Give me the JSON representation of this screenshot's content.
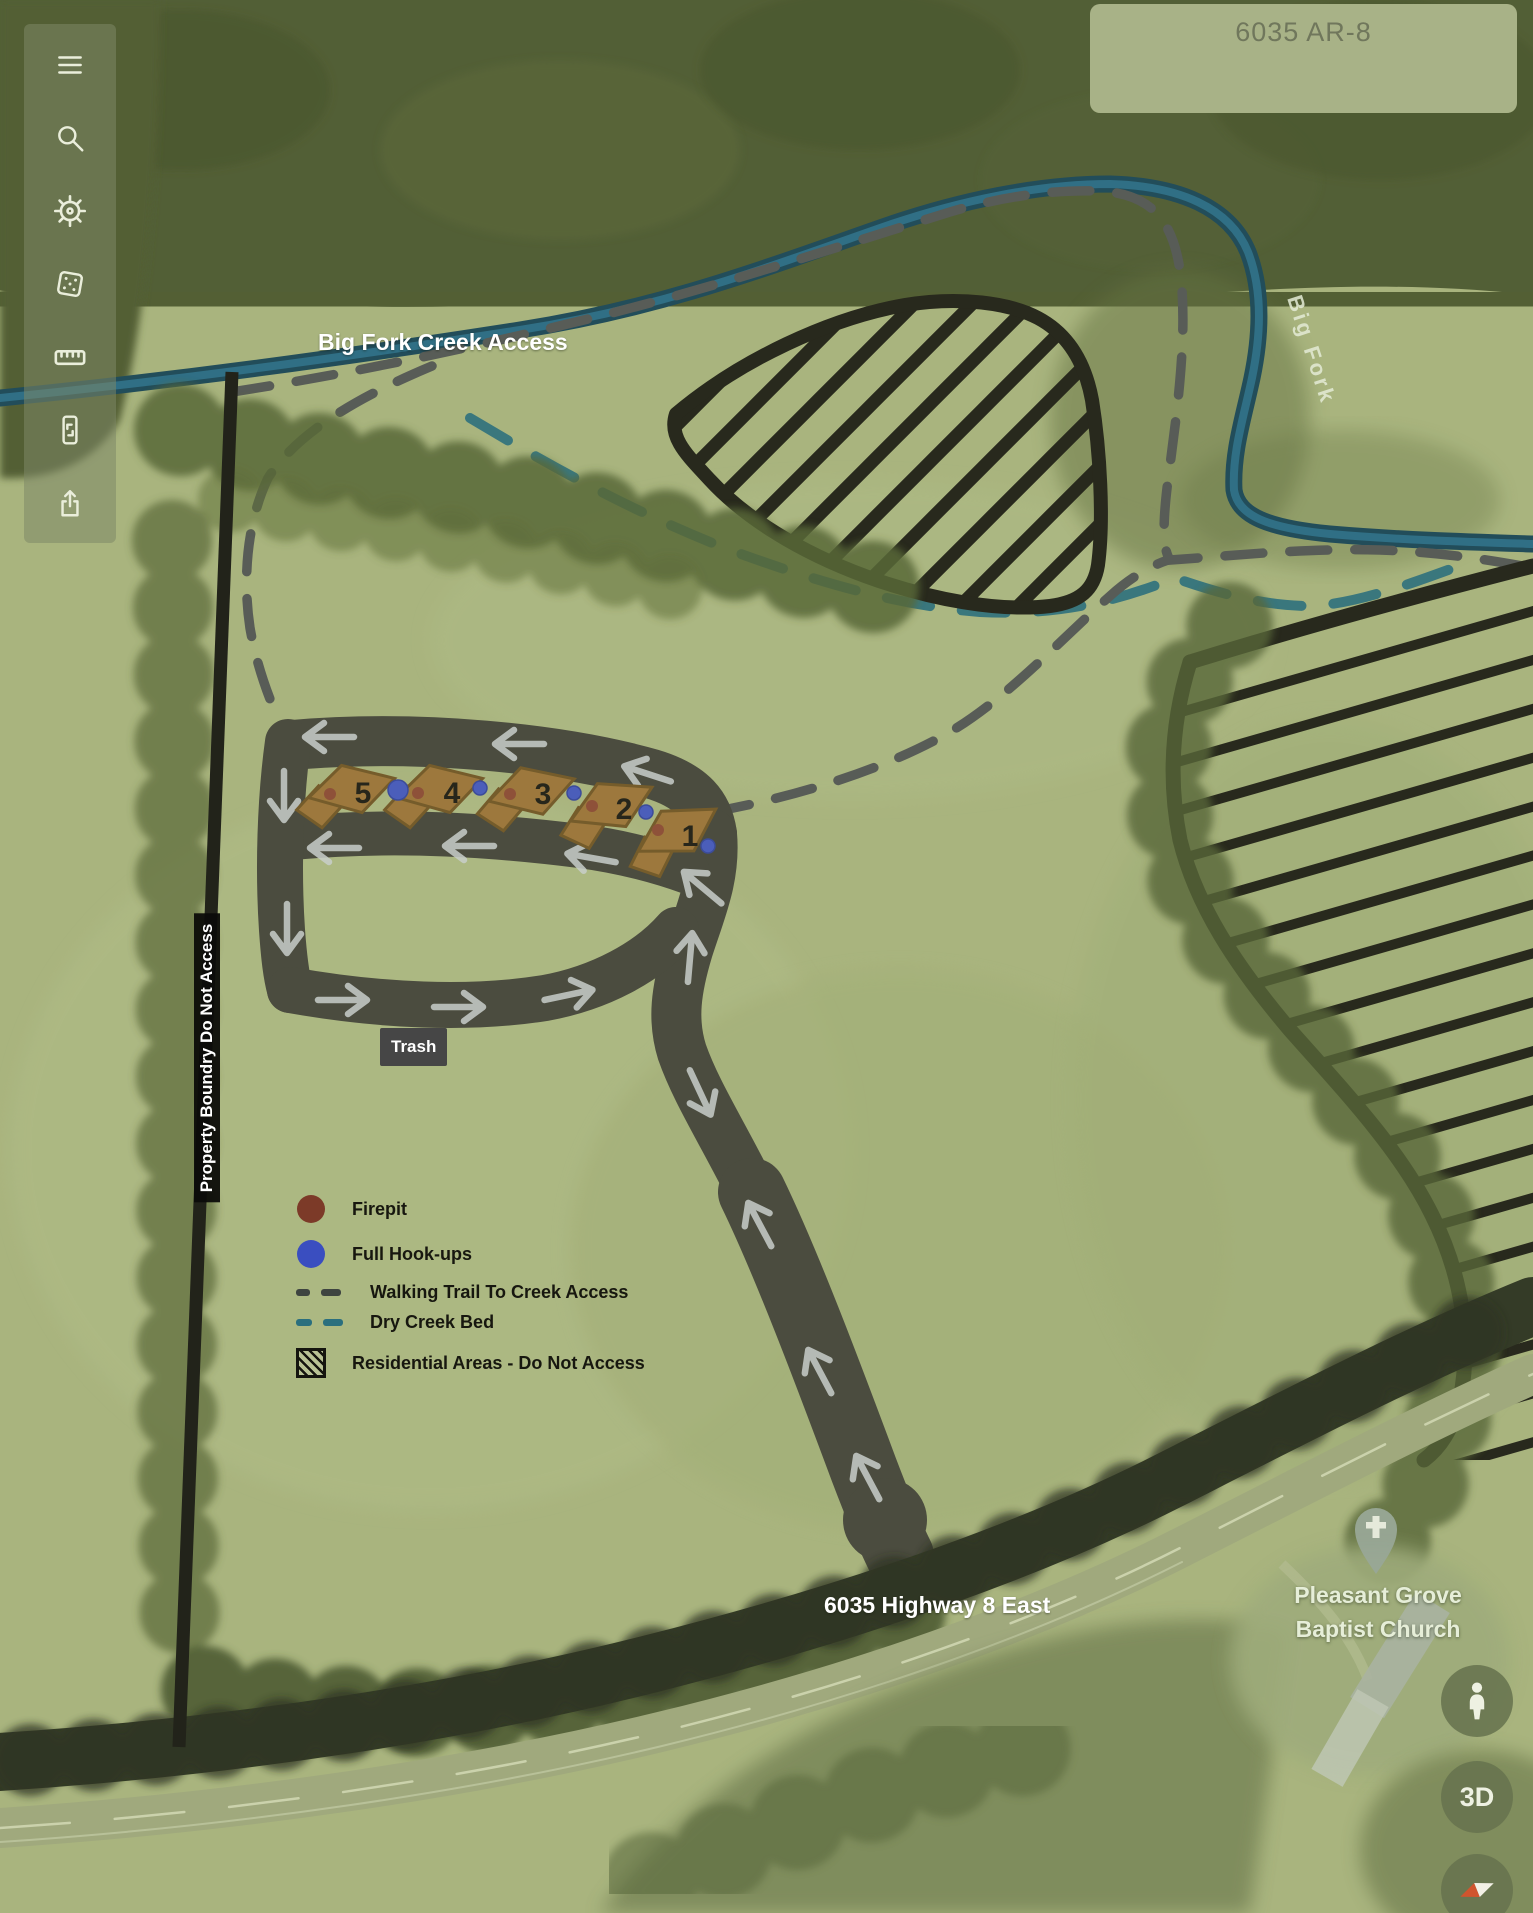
{
  "route_card": {
    "label": "6035 AR-8"
  },
  "sidebar": {
    "icons": [
      {
        "name": "menu"
      },
      {
        "name": "search"
      },
      {
        "name": "helm"
      },
      {
        "name": "dice"
      },
      {
        "name": "ruler"
      },
      {
        "name": "device"
      },
      {
        "name": "share"
      }
    ]
  },
  "labels": {
    "creek_access": "Big Fork Creek Access",
    "property_boundary": "Property Boundry Do Not Access",
    "trash": "Trash",
    "highway": "6035 Highway 8 East",
    "creek_name": "Big Fork",
    "church": {
      "line1": "Pleasant Grove",
      "line2": "Baptist Church"
    }
  },
  "campsites": [
    {
      "number": "1"
    },
    {
      "number": "2"
    },
    {
      "number": "3"
    },
    {
      "number": "4"
    },
    {
      "number": "5"
    }
  ],
  "legend": {
    "items": [
      {
        "label": "Firepit"
      },
      {
        "label": "Full Hook-ups"
      },
      {
        "label": "Walking Trail To Creek Access"
      },
      {
        "label": "Dry Creek Bed"
      },
      {
        "label": "Residential Areas - Do Not Access"
      }
    ]
  },
  "controls": {
    "threed": "3D"
  },
  "colors": {
    "firepit": "#7c3a28",
    "hookup": "#3a4ec0",
    "walking_trail": "#4c5052",
    "dry_creek": "#2a6f7e",
    "road": "#3d3d36",
    "creek": "#1e6687",
    "boundary": "#0e0e0c"
  }
}
